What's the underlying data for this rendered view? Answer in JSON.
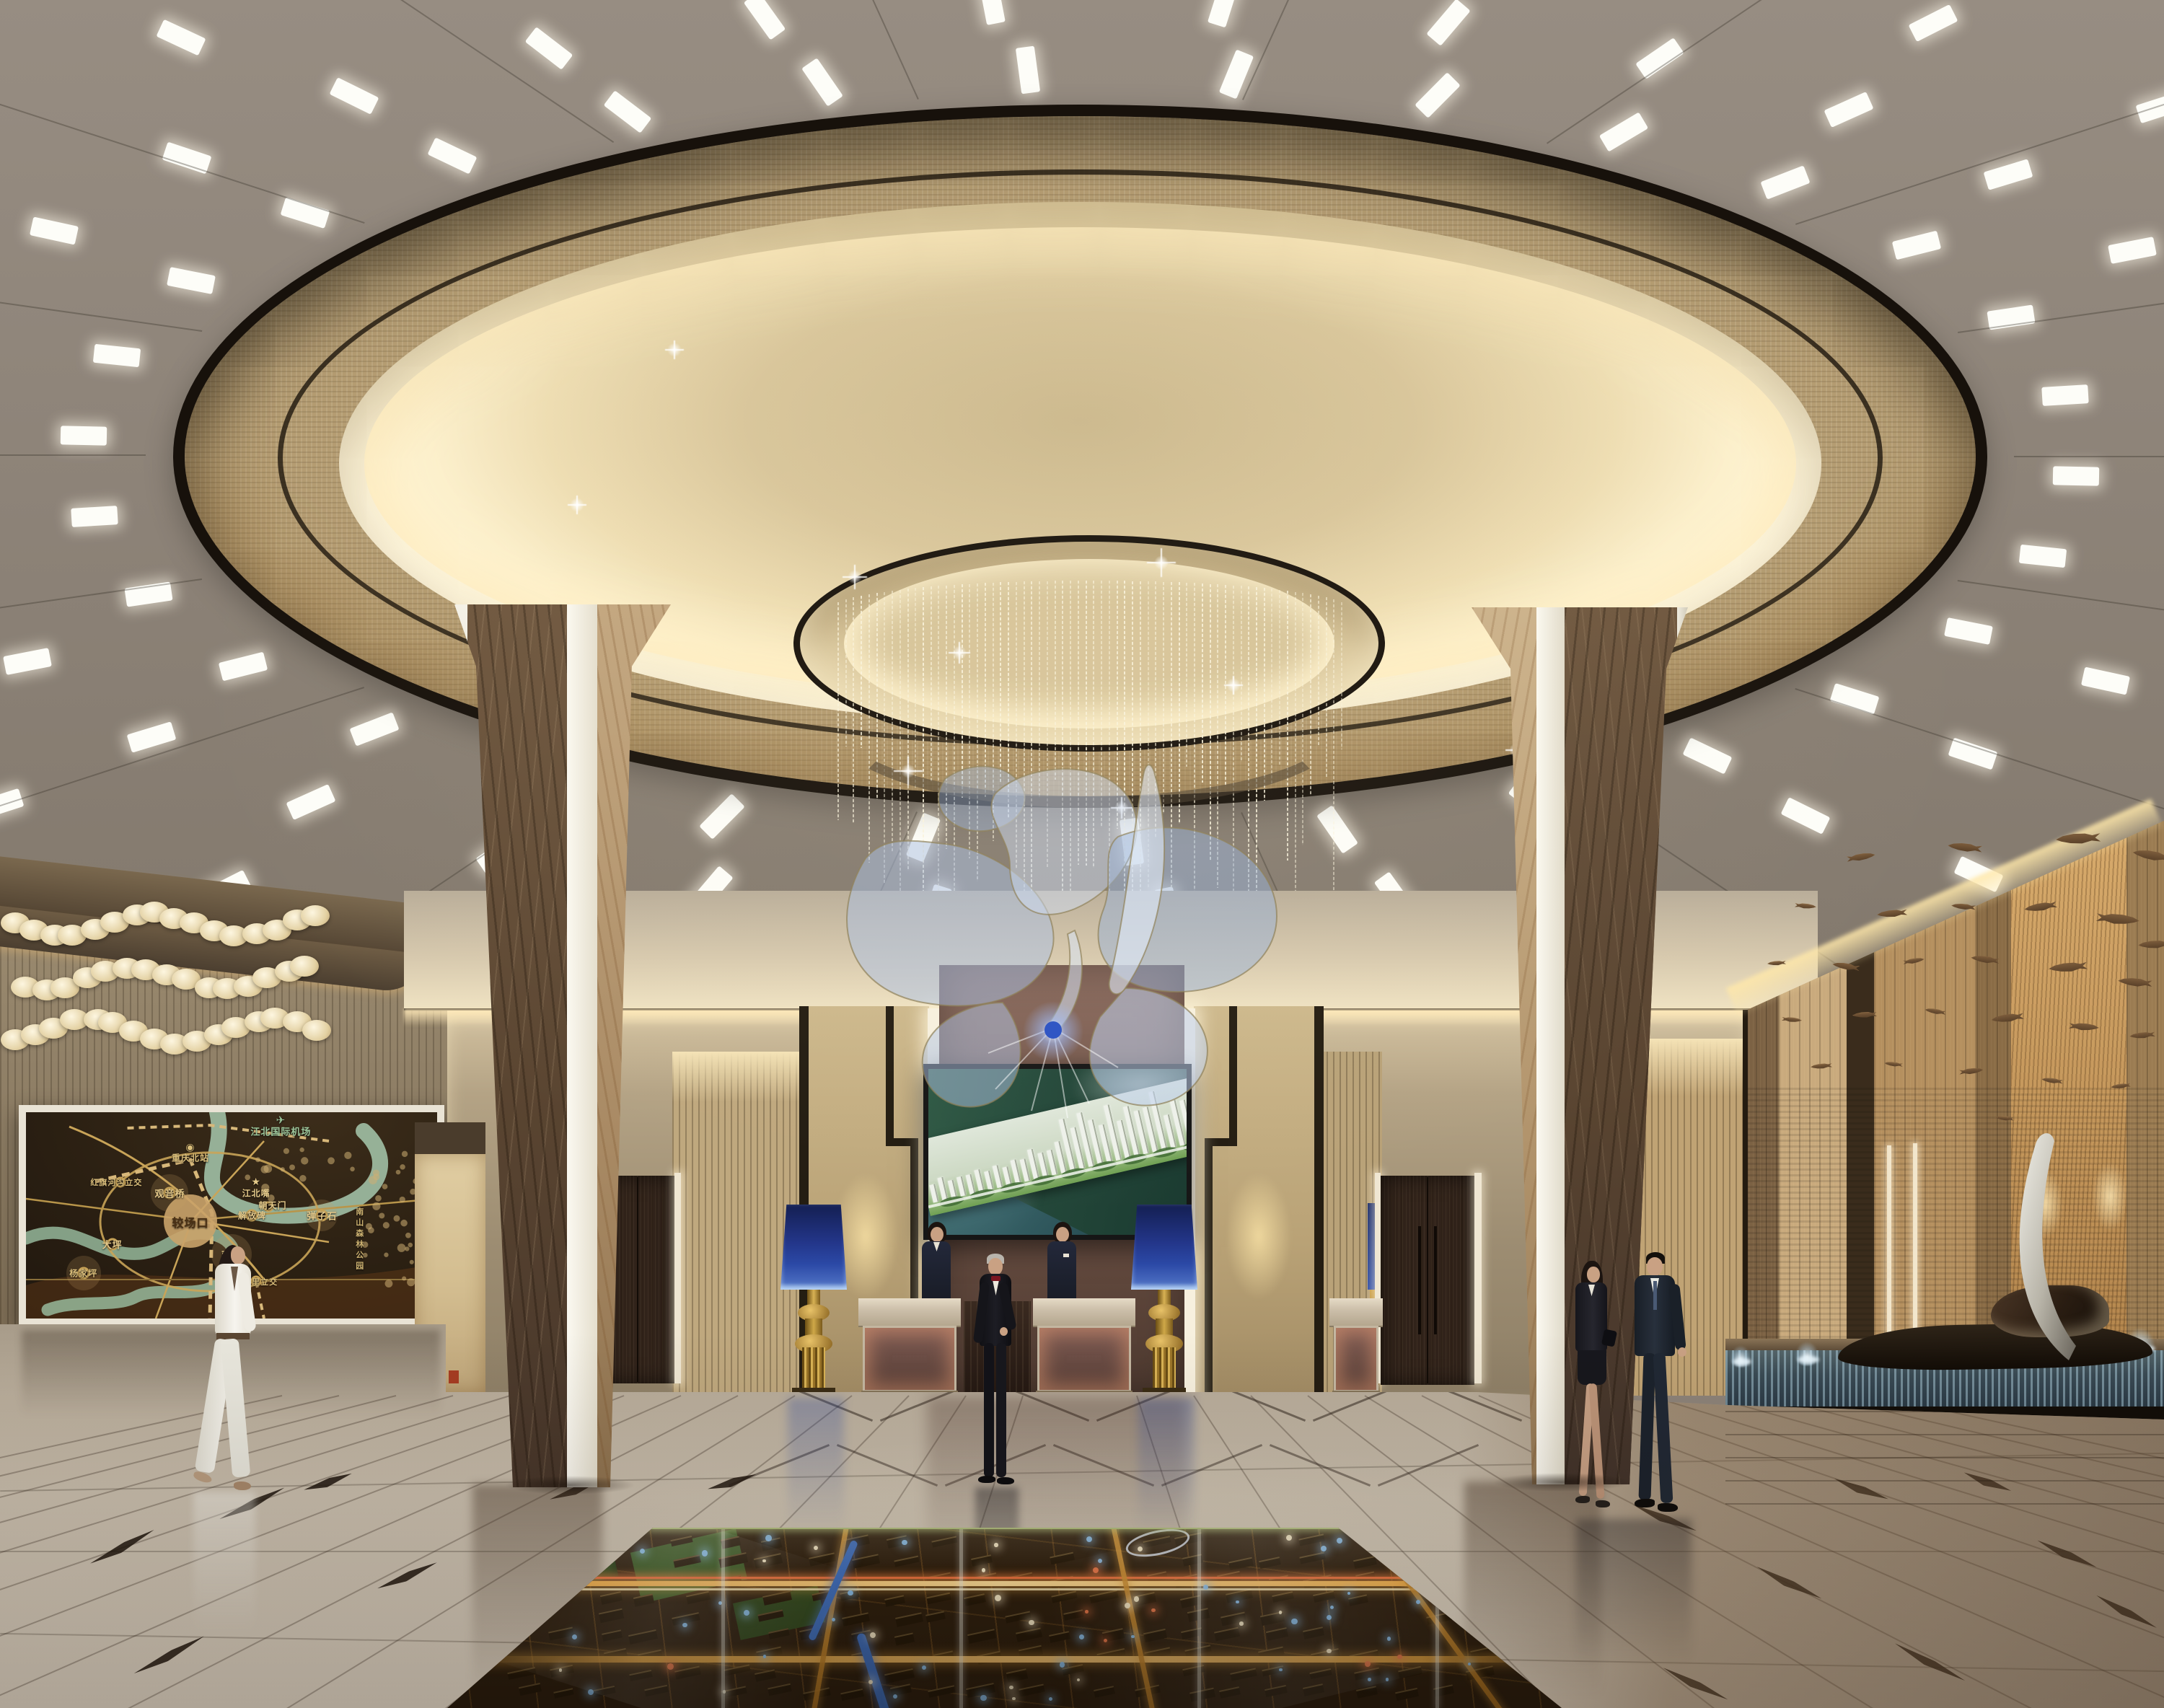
{
  "scene": {
    "setting": "real-estate sales center lobby, photorealistic interior rendering",
    "focal_points": [
      "circular coffered ceiling dome",
      "crystal bead chandelier with blue ribbon sculpture",
      "video wall showing residential masterplan",
      "illuminated city model under glass floor"
    ]
  },
  "colors": {
    "ceiling_taupe": "#8d8379",
    "dome_band": "#b49c72",
    "dome_fabric": "#e8d8ae",
    "dome_cove": "#fff3cf",
    "trim_black": "#17110b",
    "wall_beige": "#b2a287",
    "wall_gold_mosaic": "#c3ad82",
    "quilt_leather": "#6f5347",
    "marble_column_dark": "#5f4b38",
    "marble_column_tan": "#ad8e6a",
    "column_stripe_white": "#efece2",
    "lamp_shade_blue": "#2b49a6",
    "lamp_base_gold": "#b08a36",
    "desk_stone": "#cdc0ab",
    "desk_quilt_backlit": "#6b4d45",
    "floor_marble": "#c3b7a5",
    "floor_accent_dark": "#1d140c",
    "model_road_amber": "#e8a23c",
    "model_water_blue": "#3f6fbe",
    "model_park_green": "#34501f",
    "wood_wall": "#b5905f",
    "fish_bronze": "#6a4e33",
    "ribbon_blue": "#9db4e0",
    "map_background": "#2a1f12",
    "map_river_green": "#a7c9ae",
    "map_road_gold": "#c9a458",
    "water_feature_blue": "#7fa3b5"
  },
  "map_panel": {
    "description": "backlit city transit map of Chongqing on left wall",
    "labels": [
      {
        "text": "江北国际机场",
        "x": 62,
        "y": 9,
        "color": "#9cc79c",
        "size": 13,
        "icon": "✈"
      },
      {
        "text": "重庆北站",
        "x": 40,
        "y": 22,
        "color": "#d9bd7a",
        "size": 12,
        "icon": "◉"
      },
      {
        "text": "红旗河沟立交",
        "x": 22,
        "y": 34,
        "color": "#d9bd7a",
        "size": 11,
        "icon": ""
      },
      {
        "text": "观音桥",
        "x": 35,
        "y": 39,
        "color": "#e4c98a",
        "size": 13,
        "icon": ""
      },
      {
        "text": "江北嘴",
        "x": 56,
        "y": 39,
        "color": "#e4c98a",
        "size": 12,
        "icon": "★"
      },
      {
        "text": "朝天门",
        "x": 60,
        "y": 45,
        "color": "#e4c98a",
        "size": 12,
        "icon": ""
      },
      {
        "text": "解放碑",
        "x": 55,
        "y": 50,
        "color": "#e4c98a",
        "size": 12,
        "icon": ""
      },
      {
        "text": "弹子石",
        "x": 72,
        "y": 50,
        "color": "#e4c98a",
        "size": 13,
        "icon": ""
      },
      {
        "text": "较场口",
        "x": 40,
        "y": 53,
        "color": "#4a3014",
        "size": 16,
        "icon": ""
      },
      {
        "text": "大坪",
        "x": 21,
        "y": 64,
        "color": "#e4c98a",
        "size": 13,
        "icon": ""
      },
      {
        "text": "南坪",
        "x": 50,
        "y": 69,
        "color": "#e4c98a",
        "size": 13,
        "icon": ""
      },
      {
        "text": "杨家坪",
        "x": 14,
        "y": 78,
        "color": "#d9bd7a",
        "size": 12,
        "icon": ""
      },
      {
        "text": "四公里立交",
        "x": 56,
        "y": 82,
        "color": "#d9bd7a",
        "size": 11,
        "icon": ""
      },
      {
        "text": "南山森林公园",
        "x": 81,
        "y": 62,
        "color": "#cdb271",
        "size": 11,
        "icon": "",
        "vertical": true
      }
    ]
  },
  "screen": {
    "content_description": "aerial rendering of riverside residential development with white high-rise towers, green landscaping and forested hills"
  },
  "model_floor": {
    "description": "illuminated urban-planning scale model recessed under glass floor: amber lit roads, blue river, green parks, glowing markers"
  },
  "people": [
    {
      "id": "walking-woman",
      "description": "woman in white pantsuit walking past wall map"
    },
    {
      "id": "receptionist-left",
      "description": "female receptionist in dark uniform behind left desk"
    },
    {
      "id": "concierge",
      "description": "silver-haired concierge in black tuxedo with red bow tie"
    },
    {
      "id": "receptionist-right",
      "description": "female receptionist in dark uniform behind right desk"
    },
    {
      "id": "visitor-woman",
      "description": "businesswoman in dark skirt suit"
    },
    {
      "id": "visitor-man",
      "description": "businessman in dark suit"
    }
  ],
  "fish_sculpture": {
    "description": "school of bronze fish mounted on wood panel wall",
    "count": 28
  },
  "fountain": {
    "description": "stone water channel with small fountain jets and silver sail sculpture"
  }
}
